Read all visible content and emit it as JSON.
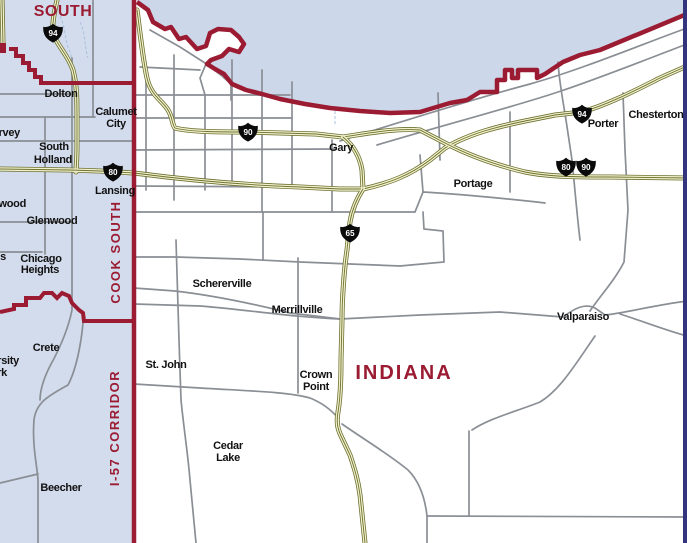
{
  "map": {
    "description_labels": {
      "region_top": "SOUTH",
      "state": "INDIANA",
      "corridor_upper": "COOK SOUTH",
      "corridor_lower": "I-57 CORRIDOR"
    },
    "colors": {
      "red": "#9b1b32",
      "lake": "#ccd7e9",
      "illinois": "#d3dcec",
      "indiana": "#ffffff",
      "road_gray": "#8a8e95",
      "hwy_outline": "#6b7030",
      "hwy_fill": "#f2f1cc",
      "edge_navy": "#34347e",
      "shield_black": "#0a0a0a",
      "shield_text": "#ffffff",
      "label_black": "#111111",
      "water_line": "#a8c0e0"
    },
    "shields": [
      {
        "n": "94",
        "x": 53,
        "y": 33
      },
      {
        "n": "80",
        "x": 113,
        "y": 172
      },
      {
        "n": "90",
        "x": 248,
        "y": 132
      },
      {
        "n": "65",
        "x": 350,
        "y": 233
      },
      {
        "n": "94",
        "x": 582,
        "y": 114
      },
      {
        "n": "80",
        "x": 566,
        "y": 167
      },
      {
        "n": "90",
        "x": 586,
        "y": 167
      }
    ],
    "labels": [
      {
        "t": "SOUTH",
        "x": 63,
        "y": 16,
        "s": 16,
        "c": "red",
        "w": 800,
        "ls": 0.5
      },
      {
        "t": "INDIANA",
        "x": 404,
        "y": 379,
        "s": 20,
        "c": "red",
        "w": 800,
        "ls": 2
      },
      {
        "t": "COOK SOUTH",
        "x": 120,
        "y": 252,
        "s": 13,
        "c": "red",
        "w": 800,
        "r": -90,
        "ls": 1.5
      },
      {
        "t": "I-57 CORRIDOR",
        "x": 119,
        "y": 428,
        "s": 13,
        "c": "red",
        "w": 800,
        "r": -90,
        "ls": 1.5
      },
      {
        "t": "Dolton",
        "x": 61,
        "y": 97
      },
      {
        "t": "Calumet",
        "x": 116,
        "y": 115
      },
      {
        "t": "City",
        "x": 116,
        "y": 127
      },
      {
        "t": "Harvey",
        "x": 20,
        "y": 136,
        "a": "end"
      },
      {
        "t": "South",
        "x": 54,
        "y": 150
      },
      {
        "t": "Holland",
        "x": 53,
        "y": 163
      },
      {
        "t": "Lansing",
        "x": 115,
        "y": 194
      },
      {
        "t": "Homewood",
        "x": 26,
        "y": 207,
        "a": "end"
      },
      {
        "t": "Glenwood",
        "x": 52,
        "y": 224
      },
      {
        "t": "Olympia Fields",
        "x": 6,
        "y": 260,
        "a": "end"
      },
      {
        "t": "Chicago",
        "x": 41,
        "y": 262
      },
      {
        "t": "Heights",
        "x": 40,
        "y": 273
      },
      {
        "t": "Crete",
        "x": 46,
        "y": 351
      },
      {
        "t": "University",
        "x": 19,
        "y": 364,
        "a": "end"
      },
      {
        "t": "Park",
        "x": 7,
        "y": 376,
        "a": "end"
      },
      {
        "t": "Beecher",
        "x": 61,
        "y": 491
      },
      {
        "t": "St. John",
        "x": 166,
        "y": 368
      },
      {
        "t": "Gary",
        "x": 341,
        "y": 151
      },
      {
        "t": "Portage",
        "x": 473,
        "y": 187
      },
      {
        "t": "Porter",
        "x": 603,
        "y": 127
      },
      {
        "t": "Chesterton",
        "x": 656,
        "y": 118
      },
      {
        "t": "Valparaiso",
        "x": 583,
        "y": 320
      },
      {
        "t": "Merrillville",
        "x": 297,
        "y": 313
      },
      {
        "t": "Schererville",
        "x": 222,
        "y": 287
      },
      {
        "t": "Crown",
        "x": 316,
        "y": 378
      },
      {
        "t": "Point",
        "x": 316,
        "y": 390
      },
      {
        "t": "Cedar",
        "x": 228,
        "y": 449
      },
      {
        "t": "Lake",
        "x": 228,
        "y": 461
      }
    ]
  }
}
